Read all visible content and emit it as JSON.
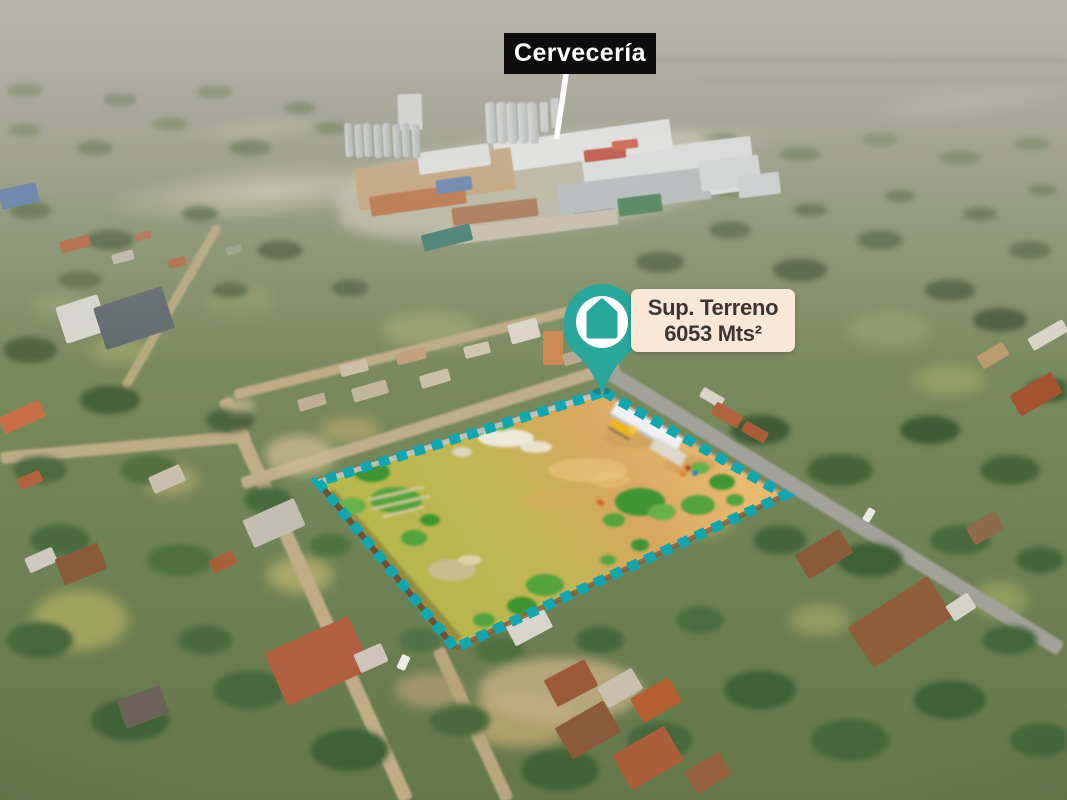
{
  "overlay": {
    "factory_callout": {
      "label": "Cervecería"
    },
    "plot_callout": {
      "title": "Sup. Terreno",
      "area": "6053 Mts²"
    }
  },
  "colors": {
    "callout_teal": "#29a79d",
    "outline_teal": "#12a7ae",
    "plot_label_bg": "#f9e8d8",
    "plot_label_text": "#3a3733",
    "factory_label_bg": "#0d0d0d",
    "factory_label_text": "#ffffff",
    "pointer_line": "#ffffff"
  }
}
